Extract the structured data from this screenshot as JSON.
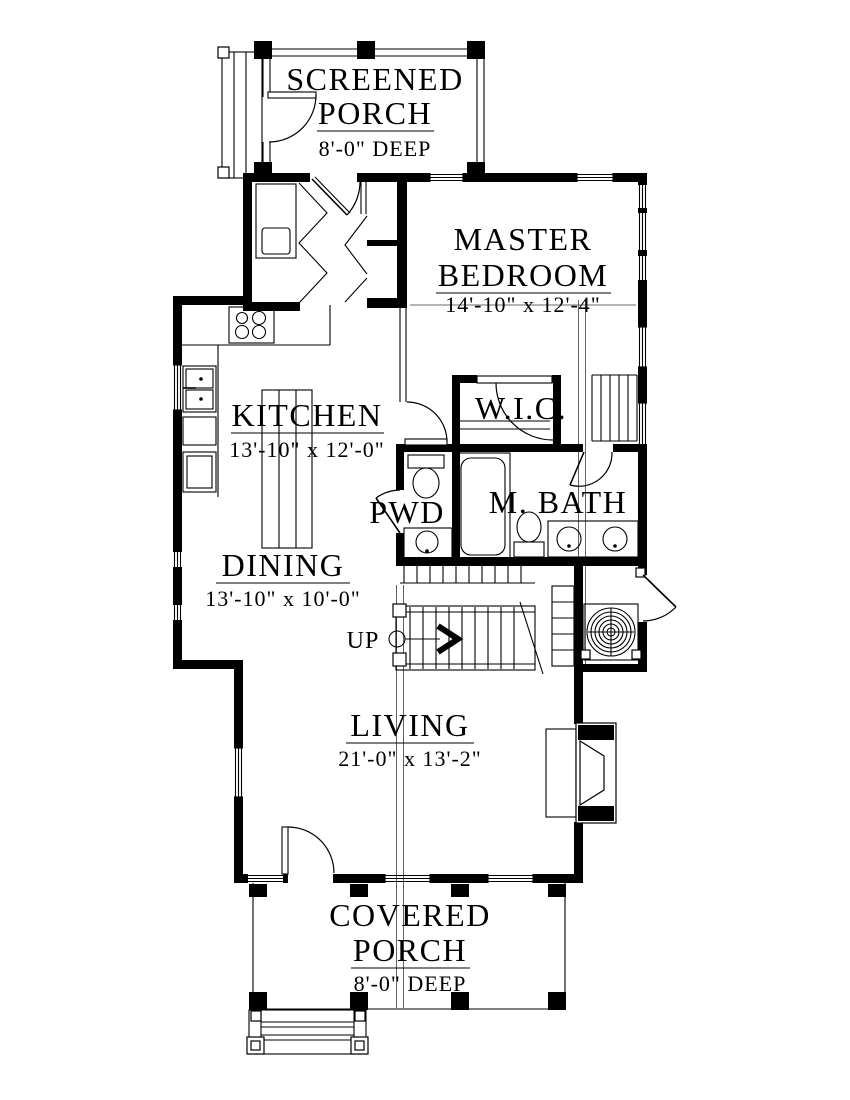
{
  "drawing": {
    "type": "first-floor-plan",
    "background": "#ffffff",
    "ink": "#000000"
  },
  "rooms": {
    "screened_porch": {
      "name_line1": "SCREENED",
      "name_line2": "PORCH",
      "dimension": "8'-0\" DEEP"
    },
    "master_bedroom": {
      "name_line1": "MASTER",
      "name_line2": "BEDROOM",
      "dimension": "14'-10\" x 12'-4\""
    },
    "kitchen": {
      "name": "KITCHEN",
      "dimension": "13'-10\" x 12'-0\""
    },
    "walk_in_closet": {
      "name": "W.I.C."
    },
    "powder_room": {
      "name": "PWD"
    },
    "master_bath": {
      "name": "M. BATH"
    },
    "dining": {
      "name": "DINING",
      "dimension": "13'-10\" x 10'-0\""
    },
    "living": {
      "name": "LIVING",
      "dimension": "21'-0\" x 13'-2\""
    },
    "covered_porch": {
      "name_line1": "COVERED",
      "name_line2": "PORCH",
      "dimension": "8'-0\" DEEP"
    }
  },
  "annotations": {
    "stair_direction": "UP"
  },
  "fixtures": [
    "range-burners",
    "kitchen-sink",
    "kitchen-island",
    "refrigerator",
    "bifold-closet-doors",
    "stair-up",
    "hvac-unit",
    "fireplace",
    "bathtub",
    "toilet",
    "powder-sink",
    "double-vanity",
    "closet-shelves",
    "porch-side-steps",
    "entry-steps"
  ]
}
